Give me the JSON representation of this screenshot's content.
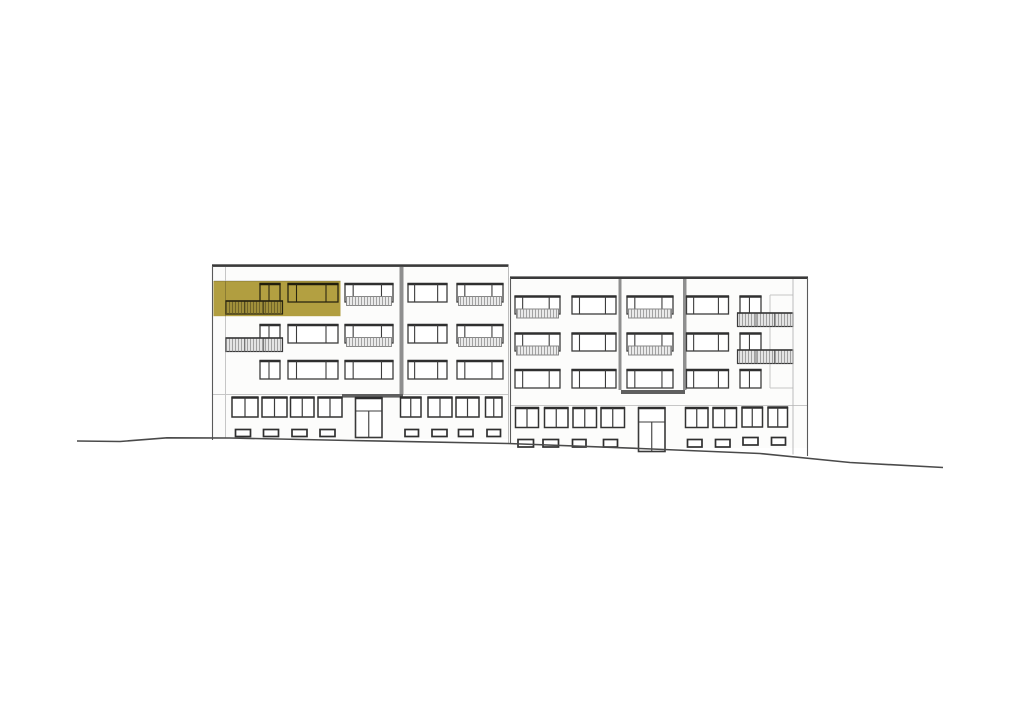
{
  "drawing": {
    "kind": "architectural-elevation",
    "subject": "four-storey apartment building street elevation with one highlighted unit",
    "colors": {
      "background": "#ffffff",
      "wall_tint": "#fcfcfb",
      "line_dark": "#3c3c3c",
      "line_medium": "#6f6f6f",
      "line_faint": "#c6c6c6",
      "roof": "#3a3a3a",
      "divider_gray": "#8f8f8f",
      "canopy_gray": "#5f5f5f",
      "rail_fill": "#eaeaea",
      "rail_hatch": "#8f8f8f",
      "balcony_fill": "#e4e4e4",
      "ground": "#4a4a4a",
      "highlight_olive": "#b3a041"
    },
    "geometry": {
      "wall_rects": [
        [
          212,
          267,
          296.5,
          172
        ],
        [
          510,
          279,
          297.5,
          169
        ]
      ],
      "roof_bars": [
        [
          212,
          264.3,
          296.5,
          2.6
        ],
        [
          510,
          276.4,
          298,
          2.6
        ]
      ],
      "edges": [
        [
          212.5,
          266,
          212.5,
          440,
          "med"
        ],
        [
          508.5,
          266,
          508.5,
          443,
          "lt"
        ],
        [
          510.5,
          278,
          510.5,
          444,
          "med"
        ],
        [
          807.5,
          278,
          807.5,
          456,
          "med"
        ],
        [
          793,
          279,
          793,
          454.5,
          "lt"
        ]
      ],
      "faint_lines": [
        [
          225.5,
          267,
          225.5,
          438
        ],
        [
          212,
          394.5,
          508,
          394.5
        ],
        [
          510,
          405.5,
          807,
          405.5
        ],
        [
          770,
          295,
          770,
          388
        ],
        [
          770,
          295,
          793,
          295
        ],
        [
          770,
          388,
          793,
          388
        ],
        [
          793,
          405.5,
          807,
          405.5
        ],
        [
          214,
          281,
          340.5,
          281
        ]
      ],
      "dividers": [
        [
          399.5,
          267,
          4,
          127.5
        ],
        [
          618.5,
          279,
          3,
          111
        ],
        [
          683,
          279,
          3.5,
          111
        ]
      ],
      "canopies": [
        [
          342,
          394,
          61,
          3.6
        ],
        [
          621,
          390,
          64,
          4
        ]
      ],
      "upper_windows": [
        [
          260,
          284,
          20,
          18,
          "sw"
        ],
        [
          288,
          284,
          50,
          18,
          "w3"
        ],
        [
          345,
          284,
          48,
          18,
          "w3"
        ],
        [
          408,
          284,
          39,
          18,
          "w3"
        ],
        [
          457,
          284,
          46,
          18,
          "w3"
        ],
        [
          260,
          325,
          20,
          18,
          "sw"
        ],
        [
          288,
          325,
          50,
          18,
          "w3"
        ],
        [
          345,
          325,
          48,
          18,
          "w3"
        ],
        [
          408,
          325,
          39,
          18,
          "w3"
        ],
        [
          457,
          325,
          46,
          18,
          "w3"
        ],
        [
          260,
          361,
          20,
          18,
          "sw"
        ],
        [
          288,
          361,
          50,
          18,
          "w3"
        ],
        [
          345,
          361,
          48,
          18,
          "w3"
        ],
        [
          408,
          361,
          39,
          18,
          "w3"
        ],
        [
          457,
          361,
          46,
          18,
          "w3"
        ],
        [
          515,
          296.5,
          45,
          17.5,
          "w3"
        ],
        [
          572,
          296.5,
          44,
          17.5,
          "w3"
        ],
        [
          627,
          296.5,
          46,
          17.5,
          "w3"
        ],
        [
          686.5,
          296.5,
          42,
          17.5,
          "w3"
        ],
        [
          740,
          296.5,
          21,
          17.5,
          "sw"
        ],
        [
          515,
          333.5,
          45,
          17.5,
          "w3"
        ],
        [
          572,
          333.5,
          44,
          17.5,
          "w3"
        ],
        [
          627,
          333.5,
          46,
          17.5,
          "w3"
        ],
        [
          686.5,
          333.5,
          42,
          17.5,
          "w3"
        ],
        [
          740,
          333.5,
          21,
          17.5,
          "sw"
        ],
        [
          515,
          370,
          45,
          18,
          "w3"
        ],
        [
          572,
          370,
          44,
          18,
          "w3"
        ],
        [
          627,
          370,
          46,
          18,
          "w3"
        ],
        [
          686.5,
          370,
          42,
          18,
          "w3"
        ],
        [
          740,
          370,
          21,
          18,
          "sw"
        ]
      ],
      "rails": [
        [
          346.5,
          296.5,
          45,
          9
        ],
        [
          458.5,
          296.5,
          43,
          9
        ],
        [
          346.5,
          337.5,
          45,
          9
        ],
        [
          458.5,
          337.5,
          43,
          9
        ],
        [
          516.5,
          309,
          42,
          9
        ],
        [
          628.5,
          309,
          43,
          9
        ],
        [
          516.5,
          346,
          42,
          9
        ],
        [
          628.5,
          346,
          43,
          9
        ]
      ],
      "balconies": [
        [
          226,
          301,
          56.5,
          13
        ],
        [
          226,
          338,
          56.5,
          13.5
        ],
        [
          737.5,
          313,
          55.5,
          13.5
        ],
        [
          737.5,
          350,
          55.5,
          13.5
        ]
      ],
      "ground_windows": [
        [
          232,
          397.5,
          26,
          19.5
        ],
        [
          262,
          397.5,
          25,
          19.5
        ],
        [
          290.5,
          397.5,
          23.5,
          19.5
        ],
        [
          318,
          397.5,
          24,
          19.5
        ],
        [
          400.5,
          397.5,
          20.5,
          19.5
        ],
        [
          428,
          397.5,
          24,
          19.5
        ],
        [
          456,
          397.5,
          23,
          19.5
        ],
        [
          485.5,
          397.5,
          16.5,
          19.5
        ],
        [
          515.5,
          408,
          23,
          19.5
        ],
        [
          544.5,
          408,
          23.5,
          19.5
        ],
        [
          573,
          408,
          23.5,
          19.5
        ],
        [
          601,
          408,
          23.5,
          19.5
        ],
        [
          685.5,
          408,
          22.5,
          19.5
        ],
        [
          713,
          408,
          23.5,
          19.5
        ],
        [
          742,
          407.5,
          20.5,
          19.5
        ],
        [
          768,
          407.5,
          19.5,
          19.5
        ]
      ],
      "doors": [
        [
          355.5,
          398,
          26.5,
          39.5,
          13
        ],
        [
          638.5,
          408,
          26.5,
          43.5,
          14
        ]
      ],
      "vents": [
        [
          235.5,
          429.5,
          15,
          7
        ],
        [
          263.5,
          429.5,
          15,
          7
        ],
        [
          292,
          429.5,
          15,
          7
        ],
        [
          320,
          429.5,
          15,
          7
        ],
        [
          405,
          429.5,
          13.5,
          7
        ],
        [
          432,
          429.5,
          15,
          7
        ],
        [
          458.5,
          429.5,
          14.5,
          7
        ],
        [
          487,
          429.5,
          13.5,
          7
        ],
        [
          518,
          439.5,
          15.5,
          7.5
        ],
        [
          543,
          439.5,
          15.5,
          7.5
        ],
        [
          572.5,
          439.5,
          13.5,
          7.5
        ],
        [
          603.5,
          439.5,
          14,
          7.5
        ],
        [
          687.5,
          439.5,
          14.5,
          7.5
        ],
        [
          715.5,
          439.5,
          14.5,
          7.5
        ],
        [
          743,
          437.5,
          15,
          7.5
        ],
        [
          771.5,
          437.5,
          14,
          7.5
        ]
      ],
      "highlight_unit": [
        213.5,
        281,
        127,
        35.2
      ],
      "ground_line": [
        [
          77,
          441
        ],
        [
          120,
          441.5
        ],
        [
          167,
          437.8
        ],
        [
          230,
          438
        ],
        [
          350,
          440.5
        ],
        [
          508,
          443.5
        ],
        [
          640,
          448.5
        ],
        [
          760,
          453.5
        ],
        [
          850,
          462.5
        ],
        [
          943,
          467.5
        ]
      ]
    }
  }
}
